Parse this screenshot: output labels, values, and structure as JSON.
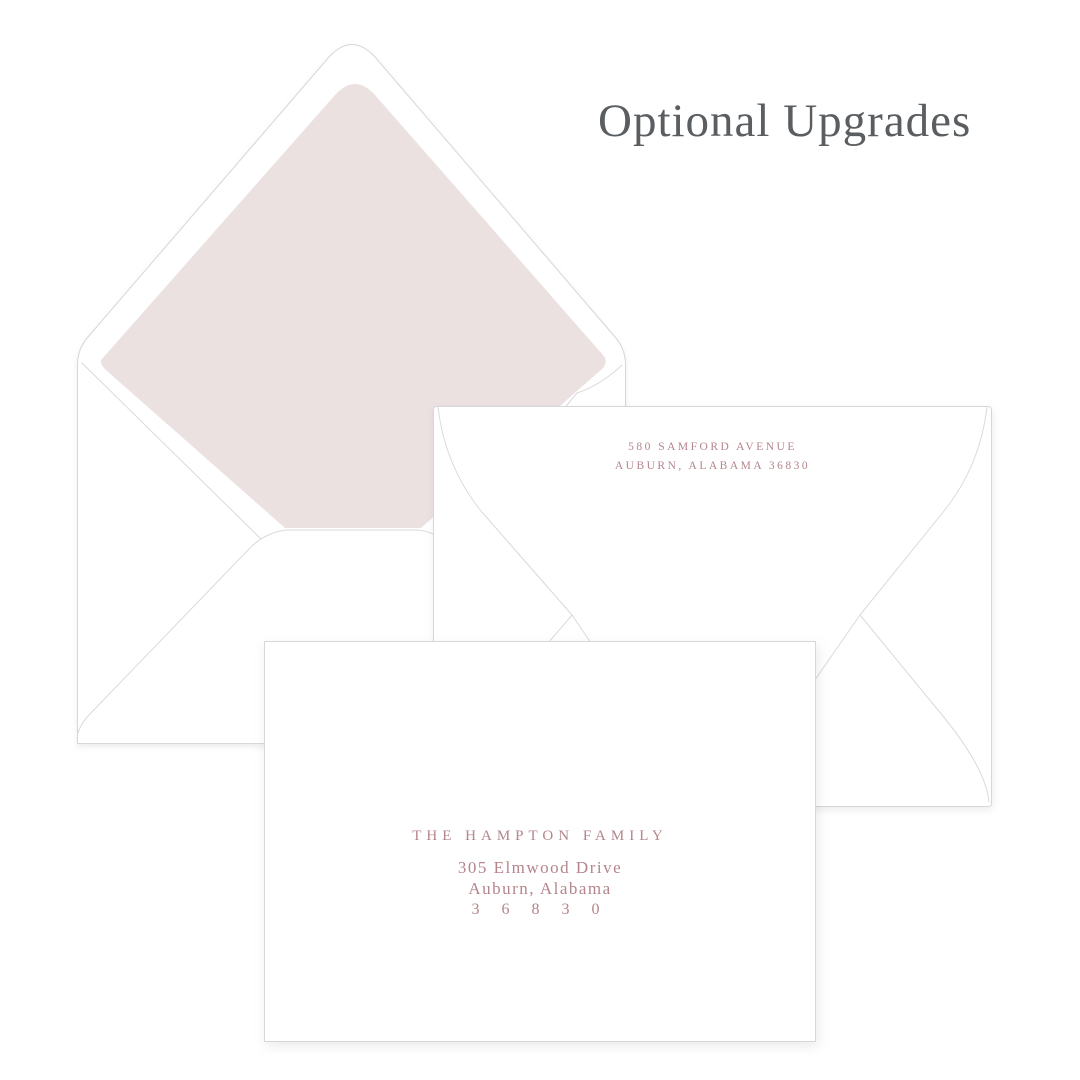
{
  "title": "Optional Upgrades",
  "back_envelope": {
    "return_address": [
      "580 SAMFORD AVENUE",
      "AUBURN, ALABAMA 36830"
    ]
  },
  "front_envelope": {
    "recipient_lines": [
      "THE HAMPTON FAMILY",
      "305 Elmwood Drive",
      "Auburn, Alabama",
      "3 6 8 3 0"
    ]
  },
  "colors": {
    "liner": "#ECE1E1",
    "address_ink": "#B4858B",
    "title_ink": "#5A5E61",
    "paper": "#FFFFFF",
    "outline": "#D7D7D9"
  }
}
